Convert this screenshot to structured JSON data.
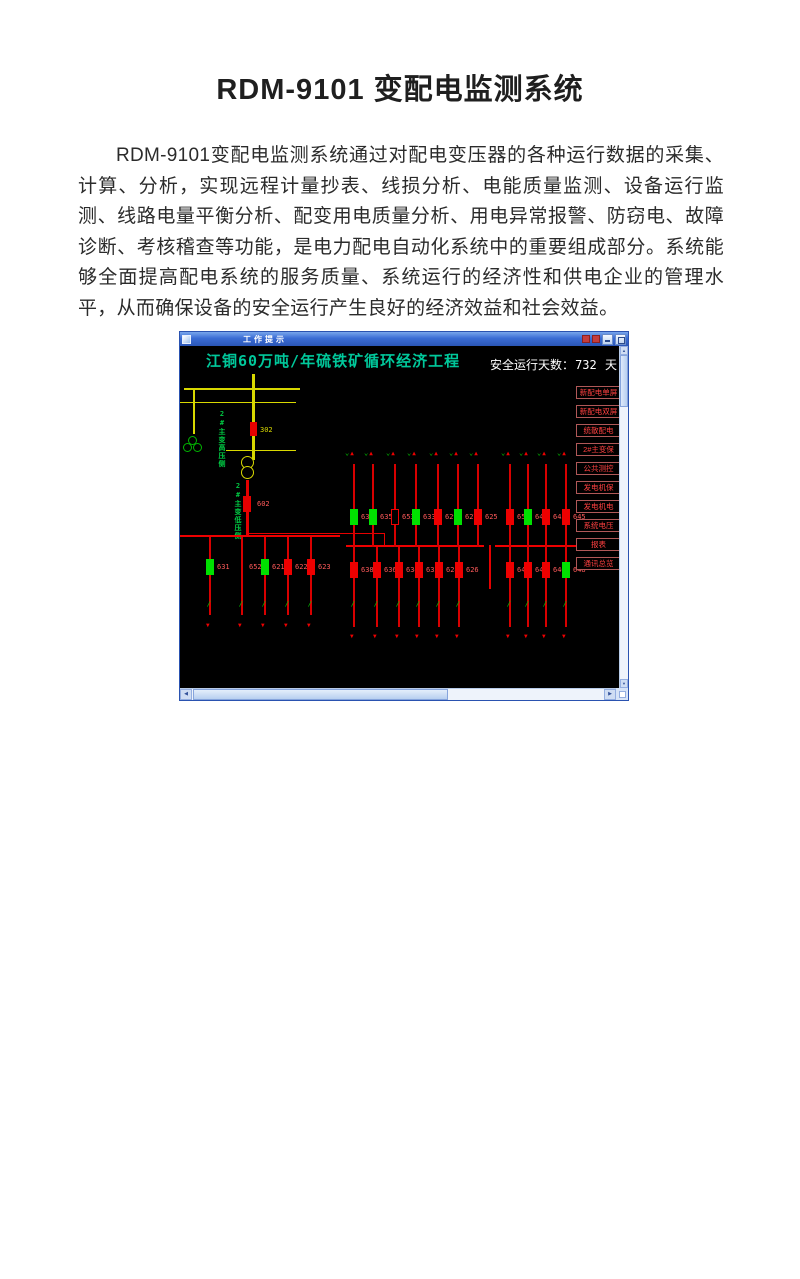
{
  "document": {
    "title": "RDM-9101 变配电监测系统",
    "body": "RDM-9101变配电监测系统通过对配电变压器的各种运行数据的采集、计算、分析，实现远程计量抄表、线损分析、电能质量监测、设备运行监测、线路电量平衡分析、配变用电质量分析、用电异常报警、防窃电、故障诊断、考核稽查等功能，是电力配电自动化系统中的重要组成部分。系统能够全面提高配电系统的服务质量、系统运行的经济性和供电企业的管理水平，从而确保设备的安全运行产生良好的经济效益和社会效益。"
  },
  "window": {
    "title": "工作提示"
  },
  "scada": {
    "header": "江铜60万吨/年硫铁矿循环经济工程",
    "safety": {
      "label": "安全运行天数：",
      "value": "732",
      "unit": "天"
    },
    "colors": {
      "header_teal": "#00c89b",
      "device_green": "#00d000",
      "bus_red": "#ee0000",
      "switch_yellow": "#d8d800",
      "alarm_red": "#ff4040",
      "closed_breaker": "#00e000"
    },
    "hv": {
      "voltages": [
        {
          "text": "Uab 36.40KV"
        },
        {
          "text": "Ubc 36.40KV"
        },
        {
          "text": "Uca 36.40KV"
        },
        {
          "text": "频率49.90Hz"
        }
      ],
      "readings": [
        {
          "text": "I:  42.00A",
          "cls": "g"
        },
        {
          "text": "P:2643.90Kw",
          "cls": "g"
        },
        {
          "text": "Q:1512.00Kvar",
          "cls": "c"
        },
        {
          "text": "COS:  0.87",
          "cls": "w"
        }
      ],
      "switches_top": [
        {
          "text": "35210",
          "x": 1
        },
        {
          "text": "352",
          "x": 24
        },
        {
          "text": "35230",
          "x": 38
        },
        {
          "text": "302110",
          "x": 52
        },
        {
          "text": "3021",
          "x": 72
        },
        {
          "text": "302130",
          "x": 92
        }
      ],
      "breaker": "302",
      "switches_bottom": [
        {
          "text": "302140",
          "x": 52
        },
        {
          "text": "3023",
          "x": 74
        },
        {
          "text": "302330",
          "x": 92
        }
      ],
      "side_label": "2#主变高压侧"
    },
    "lv": {
      "voltages": [
        {
          "text": "Uab 6.27KV"
        },
        {
          "text": "Ubc 6.28KV"
        },
        {
          "text": "Uca 6.27KV"
        },
        {
          "text": "频率49.90Hz"
        }
      ],
      "readings": [
        {
          "text": "I: 240.00A",
          "cls": "g"
        },
        {
          "text": "P:2690.40Kw",
          "cls": "g"
        },
        {
          "text": "Q:1471.20Kvar",
          "cls": "c"
        },
        {
          "text": "COS:  0.88",
          "cls": "w"
        }
      ],
      "incomer": "602",
      "side_label": "2#主变低压侧"
    },
    "bus_labels": [
      {
        "text": "II 段母线",
        "x": 1,
        "y": 152
      },
      {
        "text": "III 段母线",
        "x": 157,
        "y": 158
      },
      {
        "text": "IV 段母线",
        "x": 313,
        "y": 158
      }
    ],
    "ties": [
      {
        "text": "6321",
        "x": 5,
        "y": 201
      },
      {
        "text": "6323",
        "x": 5,
        "y": 228
      },
      {
        "text": "6233",
        "x": 300,
        "y": 205
      },
      {
        "text": "6231",
        "x": 300,
        "y": 230
      }
    ],
    "top_labels": [
      {
        "text": "备用",
        "x": 169
      },
      {
        "text": "铁路变压器",
        "x": 187
      },
      {
        "text": "PT柜",
        "x": 209
      },
      {
        "text": "开炉风机",
        "x": 231
      },
      {
        "text": "3#余热循环水泵",
        "x": 251
      },
      {
        "text": "2#余热循环水泵",
        "x": 272
      },
      {
        "text": "1#余热循环水泵",
        "x": 292
      },
      {
        "text": "PT柜",
        "x": 324
      },
      {
        "text": "1#循环泵",
        "x": 342
      },
      {
        "text": "2#循环泵",
        "x": 362
      },
      {
        "text": "3#循环泵",
        "x": 382
      }
    ],
    "bottom_labels": [
      {
        "text": "母线计量柜",
        "x": -2
      },
      {
        "text": "母联断路器柜",
        "x": 22
      },
      {
        "text": "PT柜",
        "x": 54
      },
      {
        "text": "1#焙烧风机",
        "x": 79
      },
      {
        "text": "15MW汽轮发电",
        "x": 106
      },
      {
        "text": "硫酸高低配电",
        "x": 131
      },
      {
        "text": "焙烧渣面变压",
        "x": 168
      },
      {
        "text": "办公食堂变压",
        "x": 188
      },
      {
        "text": "原料库变压",
        "x": 210
      },
      {
        "text": "余热发电变压",
        "x": 233
      },
      {
        "text": "焙烧工段变压",
        "x": 255
      },
      {
        "text": "2#焙烧风机",
        "x": 276
      },
      {
        "text": "母线隔离柜",
        "x": 297
      },
      {
        "text": "电源进线",
        "x": 325
      },
      {
        "text": "SO2主鼓风机",
        "x": 348
      },
      {
        "text": "硫酸宿舍所用变",
        "x": 370
      },
      {
        "text": "备用",
        "x": 391
      }
    ],
    "feeders_upper3": [
      {
        "id": "637",
        "x": 170,
        "color": "green"
      },
      {
        "id": "635",
        "x": 189,
        "color": "green"
      },
      {
        "id": "653",
        "x": 211,
        "color": "hollow"
      },
      {
        "id": "633",
        "x": 232,
        "color": "green"
      },
      {
        "id": "629",
        "x": 254,
        "color": "red"
      },
      {
        "id": "627",
        "x": 274,
        "color": "green"
      },
      {
        "id": "625",
        "x": 294,
        "color": "red"
      }
    ],
    "feeders_upper4": [
      {
        "id": "654",
        "x": 326,
        "color": "red"
      },
      {
        "id": "641",
        "x": 344,
        "color": "green"
      },
      {
        "id": "643",
        "x": 362,
        "color": "red"
      },
      {
        "id": "645",
        "x": 382,
        "color": "red"
      }
    ],
    "feeders_lower2": [
      {
        "id": "631",
        "x": 26,
        "color": "green"
      },
      {
        "id": "652",
        "x": 58,
        "color": "switch"
      },
      {
        "id": "621",
        "x": 81,
        "color": "green"
      },
      {
        "id": "622",
        "x": 104,
        "color": "red"
      },
      {
        "id": "623",
        "x": 127,
        "color": "red"
      }
    ],
    "feeders_lower3": [
      {
        "id": "638",
        "x": 170,
        "color": "red"
      },
      {
        "id": "636",
        "x": 193,
        "color": "red"
      },
      {
        "id": "634",
        "x": 215,
        "color": "red"
      },
      {
        "id": "632",
        "x": 235,
        "color": "red"
      },
      {
        "id": "628",
        "x": 255,
        "color": "red"
      },
      {
        "id": "626",
        "x": 275,
        "color": "red"
      }
    ],
    "feeders_lower4": [
      {
        "id": "642",
        "x": 326,
        "color": "red"
      },
      {
        "id": "644",
        "x": 344,
        "color": "red"
      },
      {
        "id": "646",
        "x": 362,
        "color": "red"
      },
      {
        "id": "648",
        "x": 382,
        "color": "green"
      }
    ]
  },
  "menu": {
    "items": [
      "新配电单屏",
      "新配电双屏",
      "统散配电",
      "2#主变保",
      "公共测控",
      "发电机保",
      "发电机电",
      "系统电压",
      "报表",
      "通讯总览"
    ]
  }
}
